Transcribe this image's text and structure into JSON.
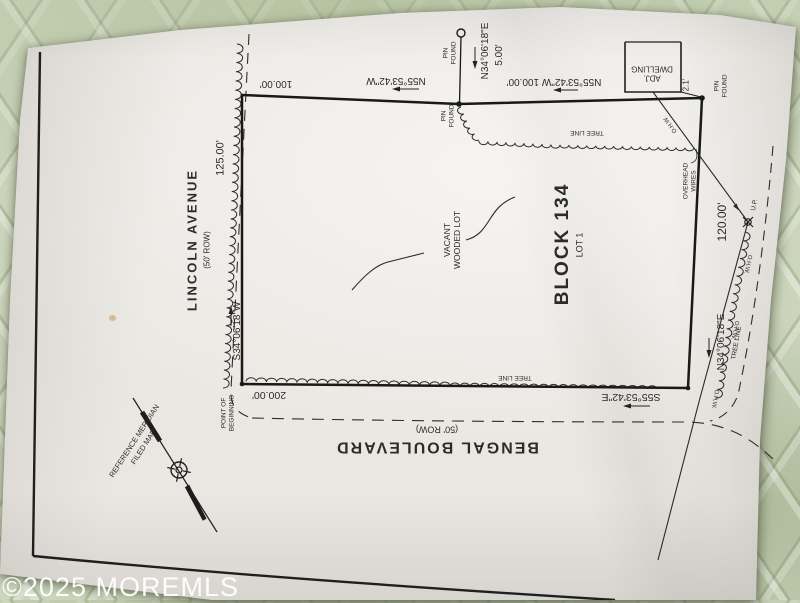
{
  "watermark": "©2025 MOREMLS",
  "streets": {
    "lincoln": {
      "name": "LINCOLN AVENUE",
      "row": "(50' ROW)"
    },
    "bengal": {
      "name": "BENGAL BOULEVARD",
      "row": "(50' ROW)"
    }
  },
  "parcel": {
    "block": "BLOCK 134",
    "lot": "LOT 1",
    "desc1": "VACANT",
    "desc2": "WOODED LOT"
  },
  "bearings": {
    "west": "S34°06'18\"W",
    "west_len": "125.00'",
    "north_left": "N55°53'42\"W",
    "north_left_len": "100.00'",
    "north_right": "N55°53'42\"W 100.00'",
    "jog": "N34°06'18\"E",
    "jog_len": "5.00'",
    "east": "N34°06'18\"E",
    "east_len": "120.00'",
    "south": "S55°53'42\"E",
    "south_len": "200.00'"
  },
  "notes": {
    "pin_found_l1": "PIN",
    "pin_found_l2": "FOUND",
    "adj_l1": "ADJ.",
    "adj_l2": "DWELLING",
    "dwelling_offset": "2.1'",
    "ow_l1": "OVERHEAD",
    "ow_l2": "WIRES",
    "ohw": "O.H.W.",
    "up": "U.P.",
    "tree_line": "TREE LINE",
    "pob_l1": "POINT OF",
    "pob_l2": "BEGINNING",
    "ref_l1": "REFERENCE MERIDIAN",
    "ref_l2": "FILED MAP"
  }
}
